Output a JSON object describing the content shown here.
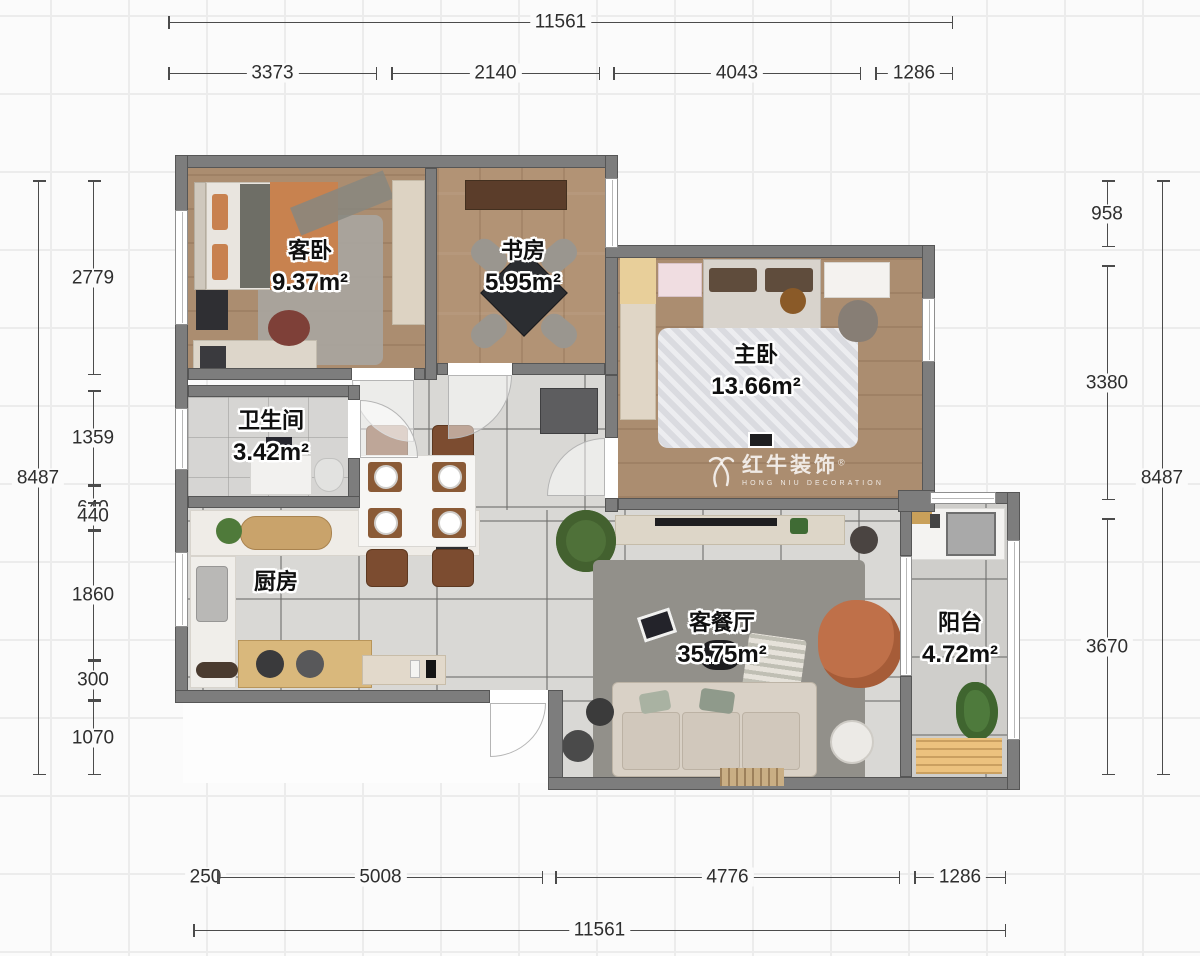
{
  "plan": {
    "rooms": [
      {
        "name": "客卧",
        "area": "9.37m²"
      },
      {
        "name": "书房",
        "area": "5.95m²"
      },
      {
        "name": "主卧",
        "area": "13.66m²"
      },
      {
        "name": "卫生间",
        "area": "3.42m²"
      },
      {
        "name": "厨房",
        "area": ""
      },
      {
        "name": "客餐厅",
        "area": "35.75m²"
      },
      {
        "name": "阳台",
        "area": "4.72m²"
      }
    ],
    "watermark": {
      "brand": "红牛装饰",
      "registered": "®",
      "subtitle": "HONG NIU DECORATION"
    }
  },
  "dimensions": {
    "top_total": "11561",
    "top_segments": [
      "3373",
      "2140",
      "4043",
      "1286"
    ],
    "bottom_segments": [
      "250",
      "5008",
      "4776",
      "1286"
    ],
    "bottom_total": "11561",
    "left_total": "8487",
    "left_segments": [
      "2779",
      "1359",
      "640",
      "440",
      "1860",
      "300",
      "1070"
    ],
    "right_segments": [
      "958",
      "3380",
      "3670"
    ],
    "right_total": "8487"
  },
  "colors": {
    "wall": "#7d7d7d",
    "wood_floor": "#b29375",
    "tile_floor": "#d9d8d5",
    "accent_orange": "#c8824f",
    "dim_line": "#4b4b4b"
  }
}
